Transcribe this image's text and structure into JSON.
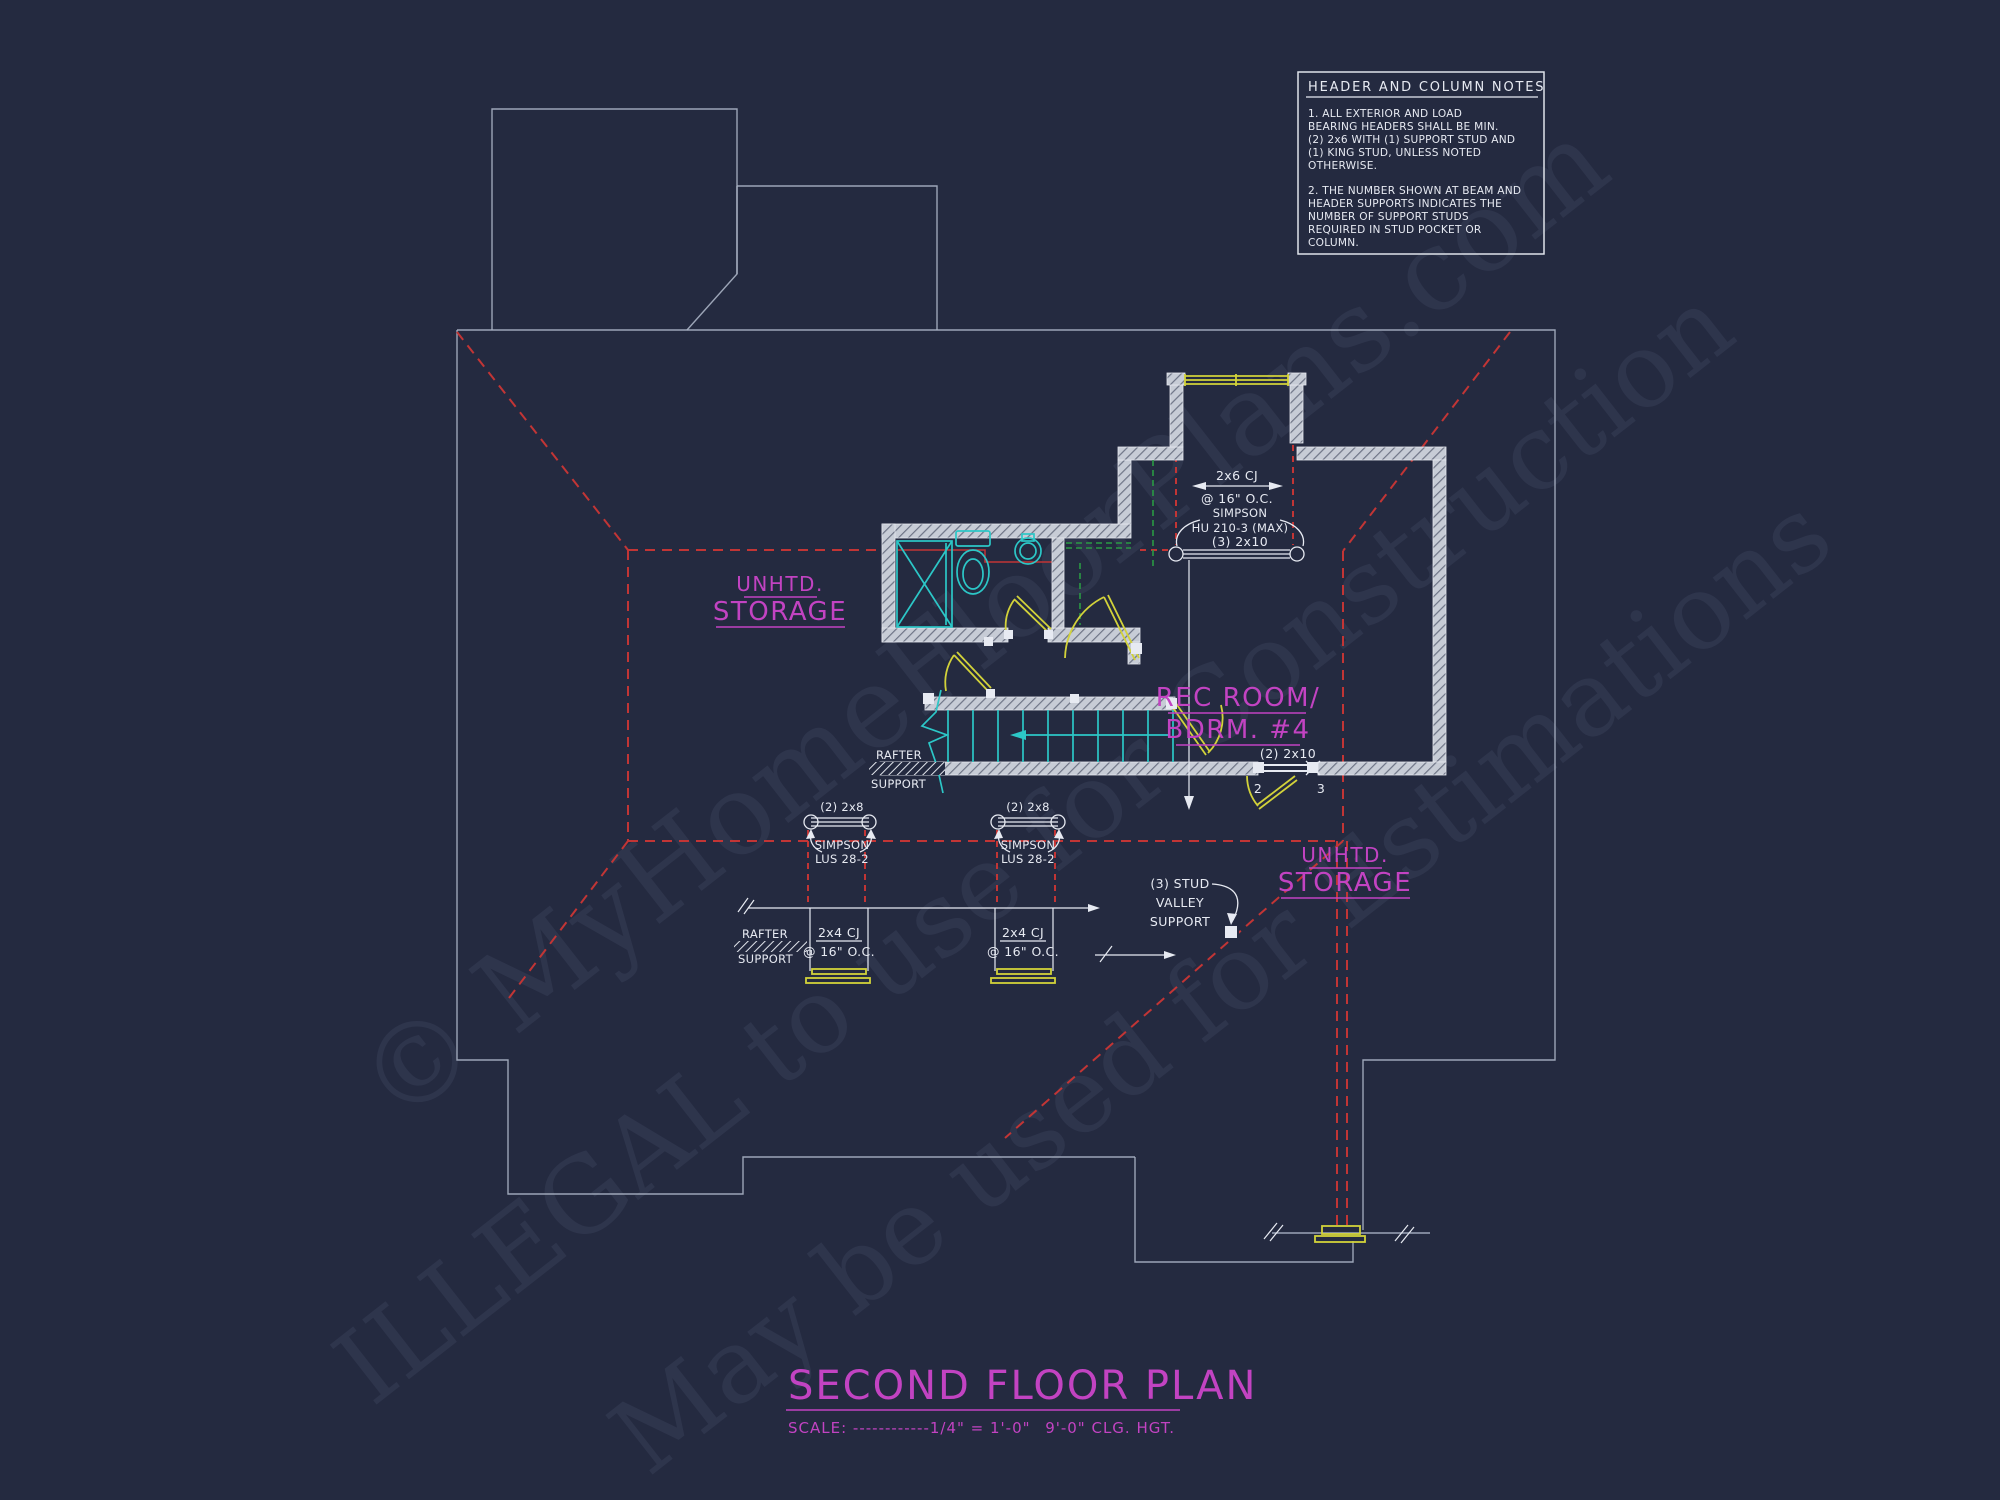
{
  "colors": {
    "bg": "#242a40",
    "white": "#e7eaf2",
    "outline": "#aab2c4",
    "red": "#c23535",
    "magenta": "#c243c2",
    "cyan": "#2cc7c7",
    "yellow": "#d2d23a",
    "green": "#2a9a44",
    "wall": "#c7ccd6",
    "wm": "#9aa6cf"
  },
  "watermark": {
    "line1": "© MyHomeFloorPlans.com",
    "line2": "ILLEGAL to use for Construction",
    "line3": "May be used for Estimations"
  },
  "notes_box": {
    "title": "HEADER AND COLUMN NOTES",
    "note1": [
      "1. ALL EXTERIOR AND LOAD",
      "BEARING HEADERS SHALL BE MIN.",
      "(2) 2x6 WITH (1) SUPPORT STUD AND",
      "(1) KING STUD, UNLESS NOTED",
      "OTHERWISE."
    ],
    "note2": [
      "2. THE NUMBER SHOWN AT BEAM AND",
      "HEADER SUPPORTS INDICATES THE",
      "NUMBER OF SUPPORT STUDS",
      "REQUIRED IN STUD POCKET OR",
      "COLUMN."
    ]
  },
  "rooms": {
    "storage_left": {
      "line1": "UNHTD.",
      "line2": "STORAGE"
    },
    "storage_right": {
      "line1": "UNHTD.",
      "line2": "STORAGE"
    },
    "rec_room": {
      "line1": "REC ROOM/",
      "line2": "BDRM. #4"
    }
  },
  "annotations": {
    "cj_top": {
      "line1": "2x6 CJ",
      "line2": "@ 16\" O.C."
    },
    "simpson_top": {
      "line1": "SIMPSON",
      "line2": "HU 210-3 (MAX)",
      "line3": "(3) 2x10"
    },
    "beam_2x10": {
      "label": "(2) 2x10",
      "left_studs": "2",
      "right_studs": "3"
    },
    "rafter_support_stairs": {
      "line1": "RAFTER",
      "line2": "SUPPORT"
    },
    "rafter_support_lower": {
      "line1": "RAFTER",
      "line2": "SUPPORT"
    },
    "beam_2x8_left": {
      "label": "(2) 2x8",
      "hanger1": "SIMPSON",
      "hanger2": "LUS 28-2"
    },
    "beam_2x8_right": {
      "label": "(2) 2x8",
      "hanger1": "SIMPSON",
      "hanger2": "LUS 28-2"
    },
    "valley_support": {
      "line1": "(3) STUD",
      "line2": "VALLEY",
      "line3": "SUPPORT"
    },
    "cj_lower_left": {
      "line1": "2x4 CJ",
      "line2": "@ 16\" O.C."
    },
    "cj_lower_right": {
      "line1": "2x4 CJ",
      "line2": "@ 16\" O.C."
    }
  },
  "title_block": {
    "title": "SECOND FLOOR PLAN",
    "scale": "SCALE: ------------1/4\" = 1'-0\"",
    "ceiling": "9'-0\" CLG. HGT."
  }
}
